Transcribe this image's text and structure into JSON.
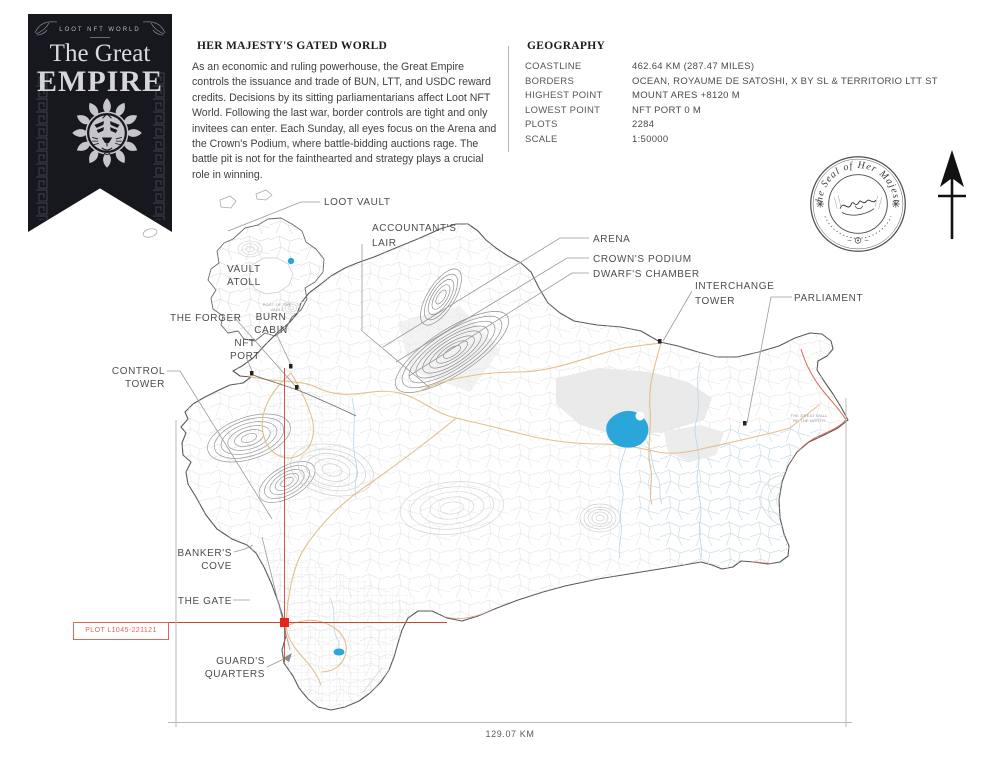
{
  "banner": {
    "kicker": "LOOT NFT WORLD",
    "title_line1": "The Great",
    "title_line2": "EMPIRE",
    "emblem": "lion-head-emblem",
    "bg_color": "#17171e"
  },
  "header": {
    "title": "HER MAJESTY'S GATED WORLD",
    "body": "As an economic and ruling powerhouse, the Great Empire controls the issuance and trade of BUN, LTT, and USDC reward credits. Decisions by its sitting parliamentarians affect Loot NFT World. Following the last war, border controls are tight and only invitees can enter. Each Sunday, all eyes focus on the Arena and the Crown's Podium, where battle-bidding auctions rage. The battle pit is not for the fainthearted and strategy plays a crucial role in winning."
  },
  "geography": {
    "heading": "GEOGRAPHY",
    "rows": [
      {
        "label": "COASTLINE",
        "value": "462.64 KM (287.47 MILES)"
      },
      {
        "label": "BORDERS",
        "value": "OCEAN, ROYAUME DE SATOSHI, X BY SL & TERRITORIO LTT ST"
      },
      {
        "label": "HIGHEST POINT",
        "value": "MOUNT ARES +8120 M"
      },
      {
        "label": "LOWEST POINT",
        "value": "NFT PORT  0 M"
      },
      {
        "label": "PLOTS",
        "value": "2284"
      },
      {
        "label": "SCALE",
        "value": "1:50000"
      }
    ]
  },
  "seal": {
    "text": "The Seal of Her Majesty",
    "icon": "royal-seal-stamp"
  },
  "compass": {
    "icon": "north-arrow"
  },
  "map": {
    "labels": {
      "loot_vault": "LOOT VAULT",
      "vault_atoll": "VAULT ATOLL",
      "accountants_lair": "ACCOUNTANT'S LAIR",
      "arena": "ARENA",
      "crowns_podium": "CROWN'S PODIUM",
      "dwarfs_chamber": "DWARF'S CHAMBER",
      "interchange_tower": "INTERCHANGE TOWER",
      "parliament": "PARLIAMENT",
      "the_forger": "THE FORGER",
      "burn_cabin": "BURN CABIN",
      "nft_port": "NFT PORT",
      "control_tower": "CONTROL TOWER",
      "bankers_cove": "BANKER'S COVE",
      "the_gate": "THE GATE",
      "guards_quarters": "GUARD'S QUARTERS",
      "port_of_the_vault": "PORT OF THE VAULT",
      "great_wall": "THE GREAT WALL OF THE NORTH"
    },
    "plot_marker": "PLOT L1045-221121",
    "scale_bar": "129.07 KM",
    "colors": {
      "lake": "#2ba6db",
      "roads": "#e2c08d",
      "wall_red": "#d96a55",
      "crosshair_red": "#cc4433",
      "marker_red": "#e8251c",
      "plot_red": "#e0655a",
      "contour_gray": "#c9c9c9"
    }
  }
}
